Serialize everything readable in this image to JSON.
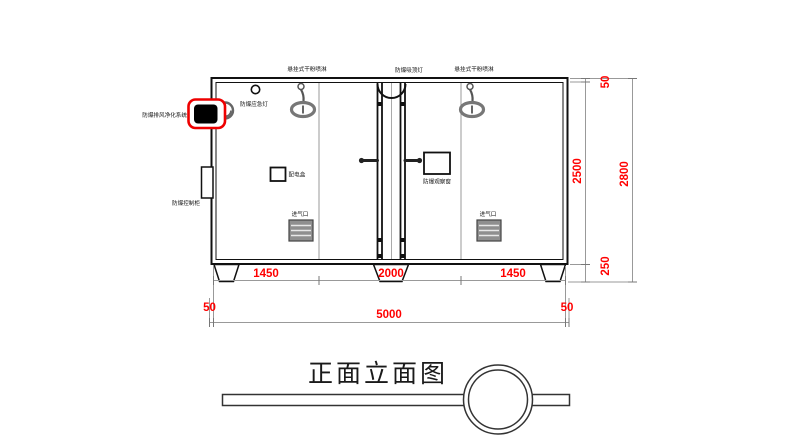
{
  "title": "正面立面图",
  "labels": {
    "sprinkler_left": "悬挂式干粉喷淋",
    "ceiling_light": "防爆吸顶灯",
    "sprinkler_right": "悬挂式干粉喷淋",
    "emergency_light": "防爆应急灯",
    "exhaust_purifier": "防爆排风净化系统",
    "control_cabinet": "防爆控制柜",
    "distribution_box": "配电盒",
    "observation_window": "防爆观察窗",
    "air_inlet_left": "进气口",
    "air_inlet_right": "进气口"
  },
  "dimensions": {
    "bottom_segments": [
      "1450",
      "2000",
      "1450"
    ],
    "bottom_offset_left": "50",
    "bottom_total": "5000",
    "bottom_offset_right": "50",
    "side_top_offset": "50",
    "side_inner_height": "2500",
    "side_total_height": "2800",
    "side_base_height": "250"
  },
  "colors": {
    "dimension_text": "#FF0000",
    "highlight_box": "#EE0000",
    "drawing_line": "#111111",
    "secondary_line": "#999999"
  }
}
